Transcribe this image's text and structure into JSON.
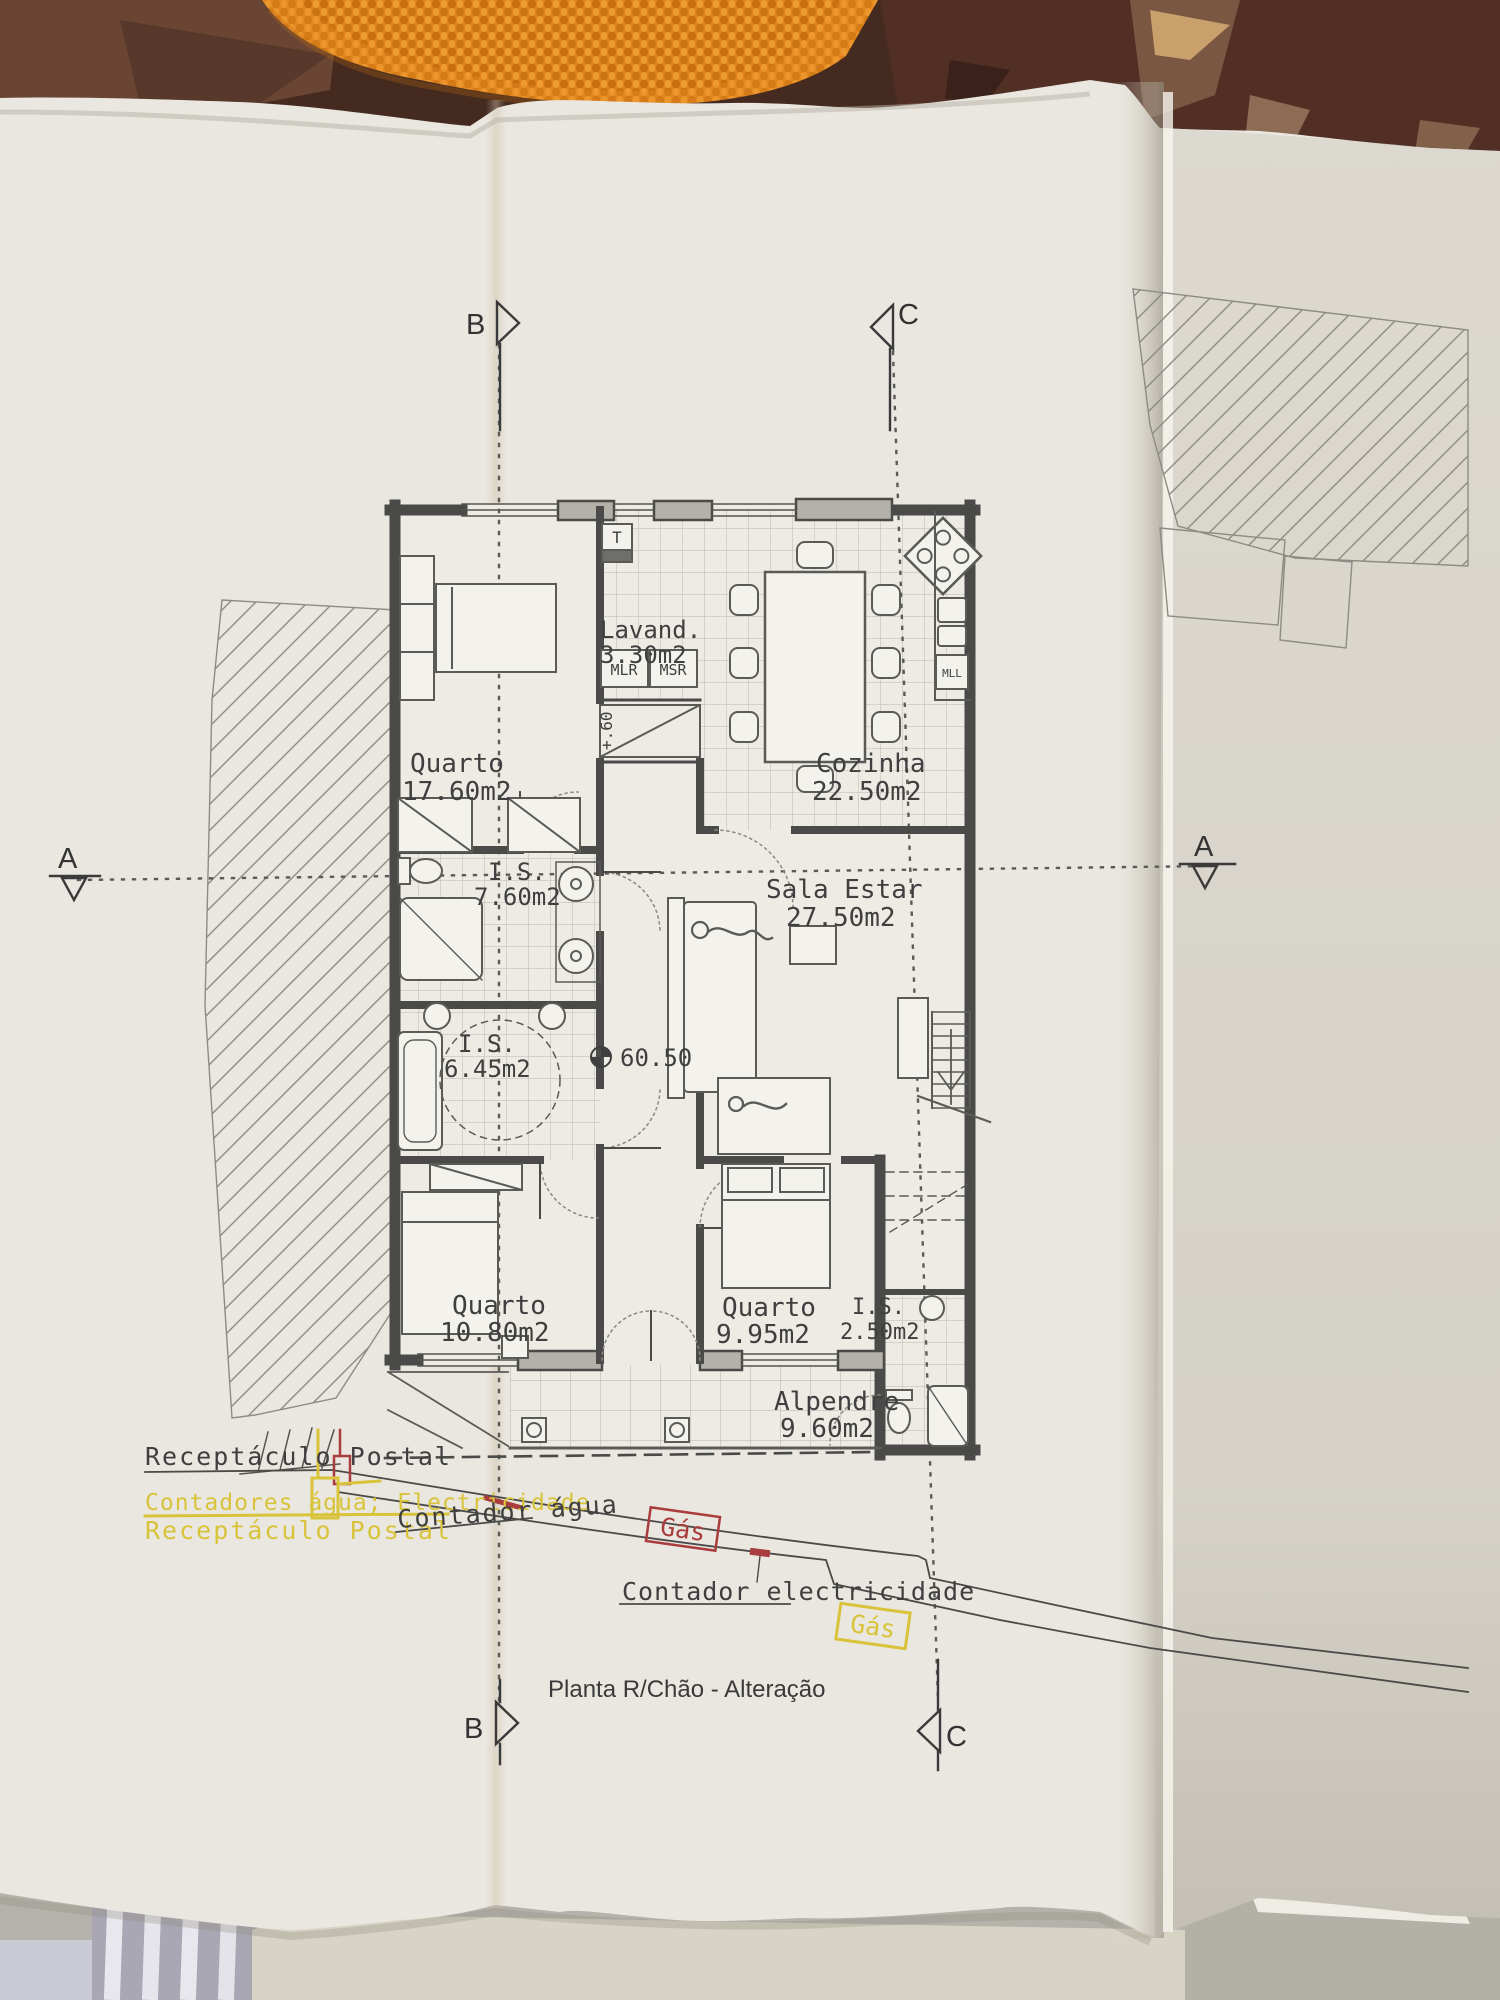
{
  "scene": {
    "background_color": "#4a2b21",
    "towel_color": "#e0861c",
    "paper_color": "#eae7e0"
  },
  "plan": {
    "title": "Planta R/Chão - Alteração",
    "level_marker": "60.50",
    "step_marker": "+.60",
    "rooms": {
      "quarto1": {
        "name": "Quarto",
        "area": "17.60m2"
      },
      "lavandaria": {
        "name": "Lavand.",
        "area": "3.30m2"
      },
      "cozinha": {
        "name": "Cozinha",
        "area": "22.50m2"
      },
      "is1": {
        "name": "I.S.",
        "area": "7.60m2"
      },
      "sala": {
        "name": "Sala Estar",
        "area": "27.50m2"
      },
      "is2": {
        "name": "I.S.",
        "area": "6.45m2"
      },
      "quarto2": {
        "name": "Quarto",
        "area": "10.80m2"
      },
      "quarto3": {
        "name": "Quarto",
        "area": "9.95m2"
      },
      "is3": {
        "name": "I.S.",
        "area": "2.50m2"
      },
      "alpendre": {
        "name": "Alpendre",
        "area": "9.60m2"
      }
    },
    "appliances": {
      "heater": "T",
      "washer": "MLR",
      "dryer": "MSR",
      "dishwasher": "MLL"
    },
    "sections": {
      "a": "A",
      "b": "B",
      "c": "C"
    },
    "annotations": {
      "postal_black": "Receptáculo Postal",
      "meters_yellow": "Contadores água; Electricidade",
      "postal_yellow": "Receptáculo Postal",
      "water_meter": "Contador água",
      "gas1": "Gás",
      "electric_meter": "Contador electricidade",
      "gas2": "Gás"
    },
    "colors": {
      "yellow": "#d9c33b",
      "red": "#a93c3c",
      "ink": "#3f3f3f"
    }
  }
}
